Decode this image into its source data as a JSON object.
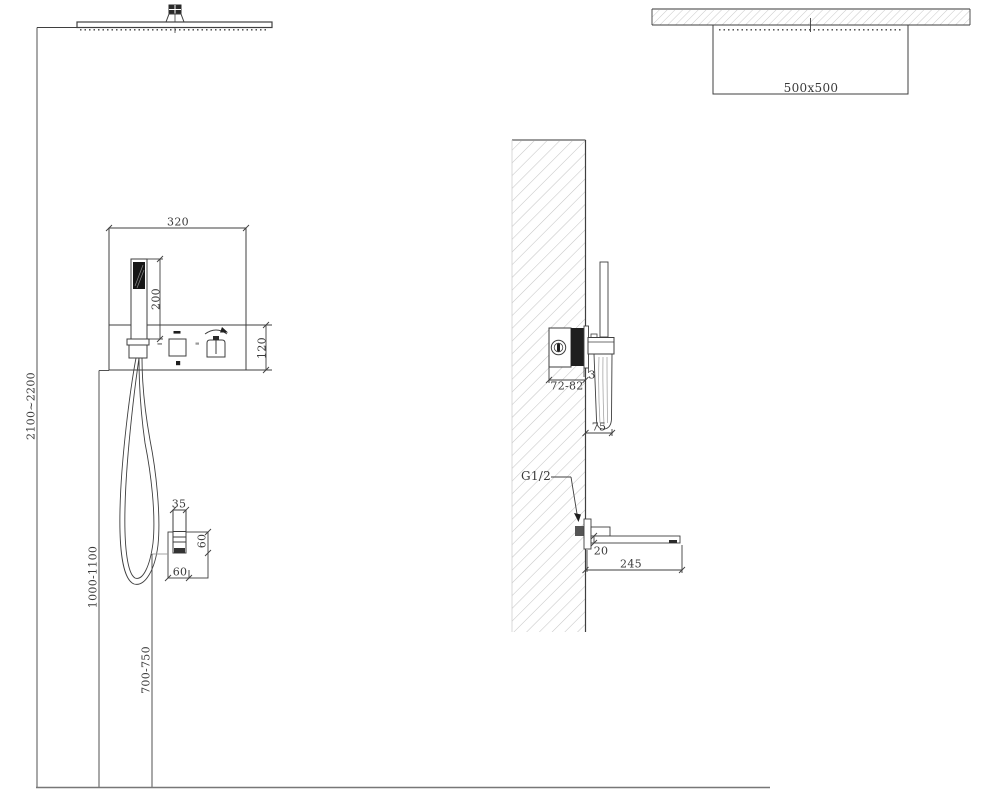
{
  "labels": {
    "panel_width": "320",
    "handshower_length": "200",
    "panel_height": "120",
    "showerhead_height_range": "2100~2200",
    "panel_height_range": "1000-1100",
    "outlet_height_range": "700-750",
    "outlet_nipple_width": "35",
    "outlet_box_height": "60",
    "outlet_box_width": "60",
    "showerhead_size": "500x500",
    "wall_embed_depth": "72-82",
    "trim_gap": "3",
    "handshower_projection": "75",
    "pipe_thread": "G1/2",
    "spout_thickness": "20",
    "spout_length": "245"
  },
  "colors": {
    "background": "#ffffff",
    "line": "#3f3f3f",
    "aux_line": "#999999",
    "hatch": "#c6c6c6",
    "fill_dark": "#1f1f1f"
  }
}
